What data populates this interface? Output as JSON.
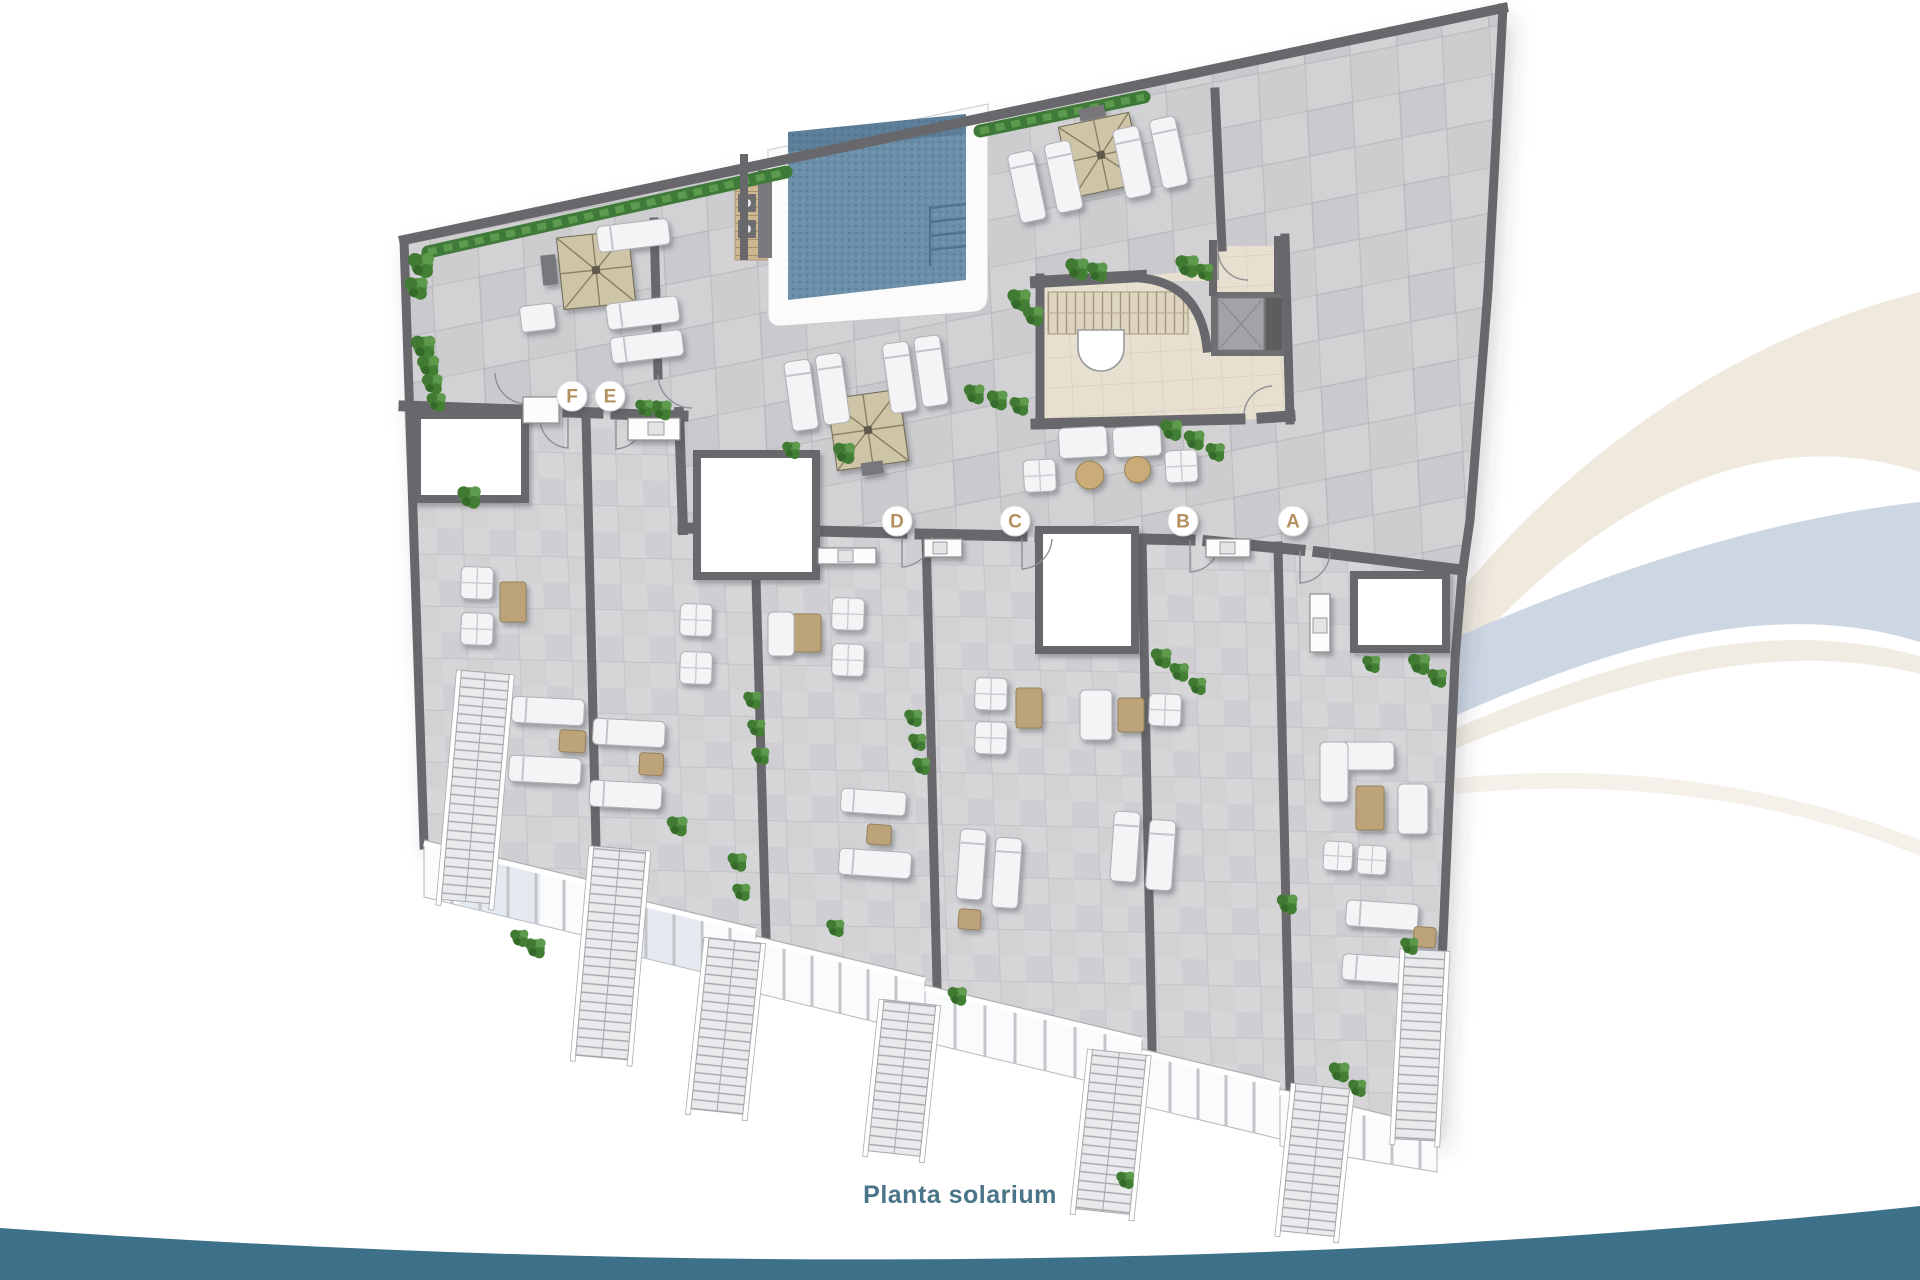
{
  "plan": {
    "caption": "Planta solarium",
    "unit_labels": [
      {
        "letter": "F",
        "x": 572,
        "y": 396
      },
      {
        "letter": "E",
        "x": 610,
        "y": 396
      },
      {
        "letter": "D",
        "x": 897,
        "y": 521
      },
      {
        "letter": "C",
        "x": 1015,
        "y": 521
      },
      {
        "letter": "B",
        "x": 1183,
        "y": 521
      },
      {
        "letter": "A",
        "x": 1293,
        "y": 521
      }
    ],
    "features": [
      "pool",
      "pergolas",
      "sun-loungers",
      "stair-core",
      "elevator",
      "private-terraces",
      "glass-balustrade",
      "planting"
    ]
  },
  "theme": {
    "caption": "#4a7588",
    "label_letter": "#b5905f",
    "teal_band": "#3d7089",
    "swoosh_beige": "#efe9de",
    "swoosh_beige_faint": "#f5f1ea",
    "swoosh_blue": "#cdd7e4",
    "wall": "#68686c",
    "floor": "#d2d2d5",
    "terrace_floor": "#d6d6d9",
    "core_floor": "#e7e0d0",
    "pool": "#6b8fa9",
    "pergola": "#cec4a6",
    "tan": "#bda379",
    "plant": "#4e8c3f",
    "railing": "#fafbfc"
  }
}
